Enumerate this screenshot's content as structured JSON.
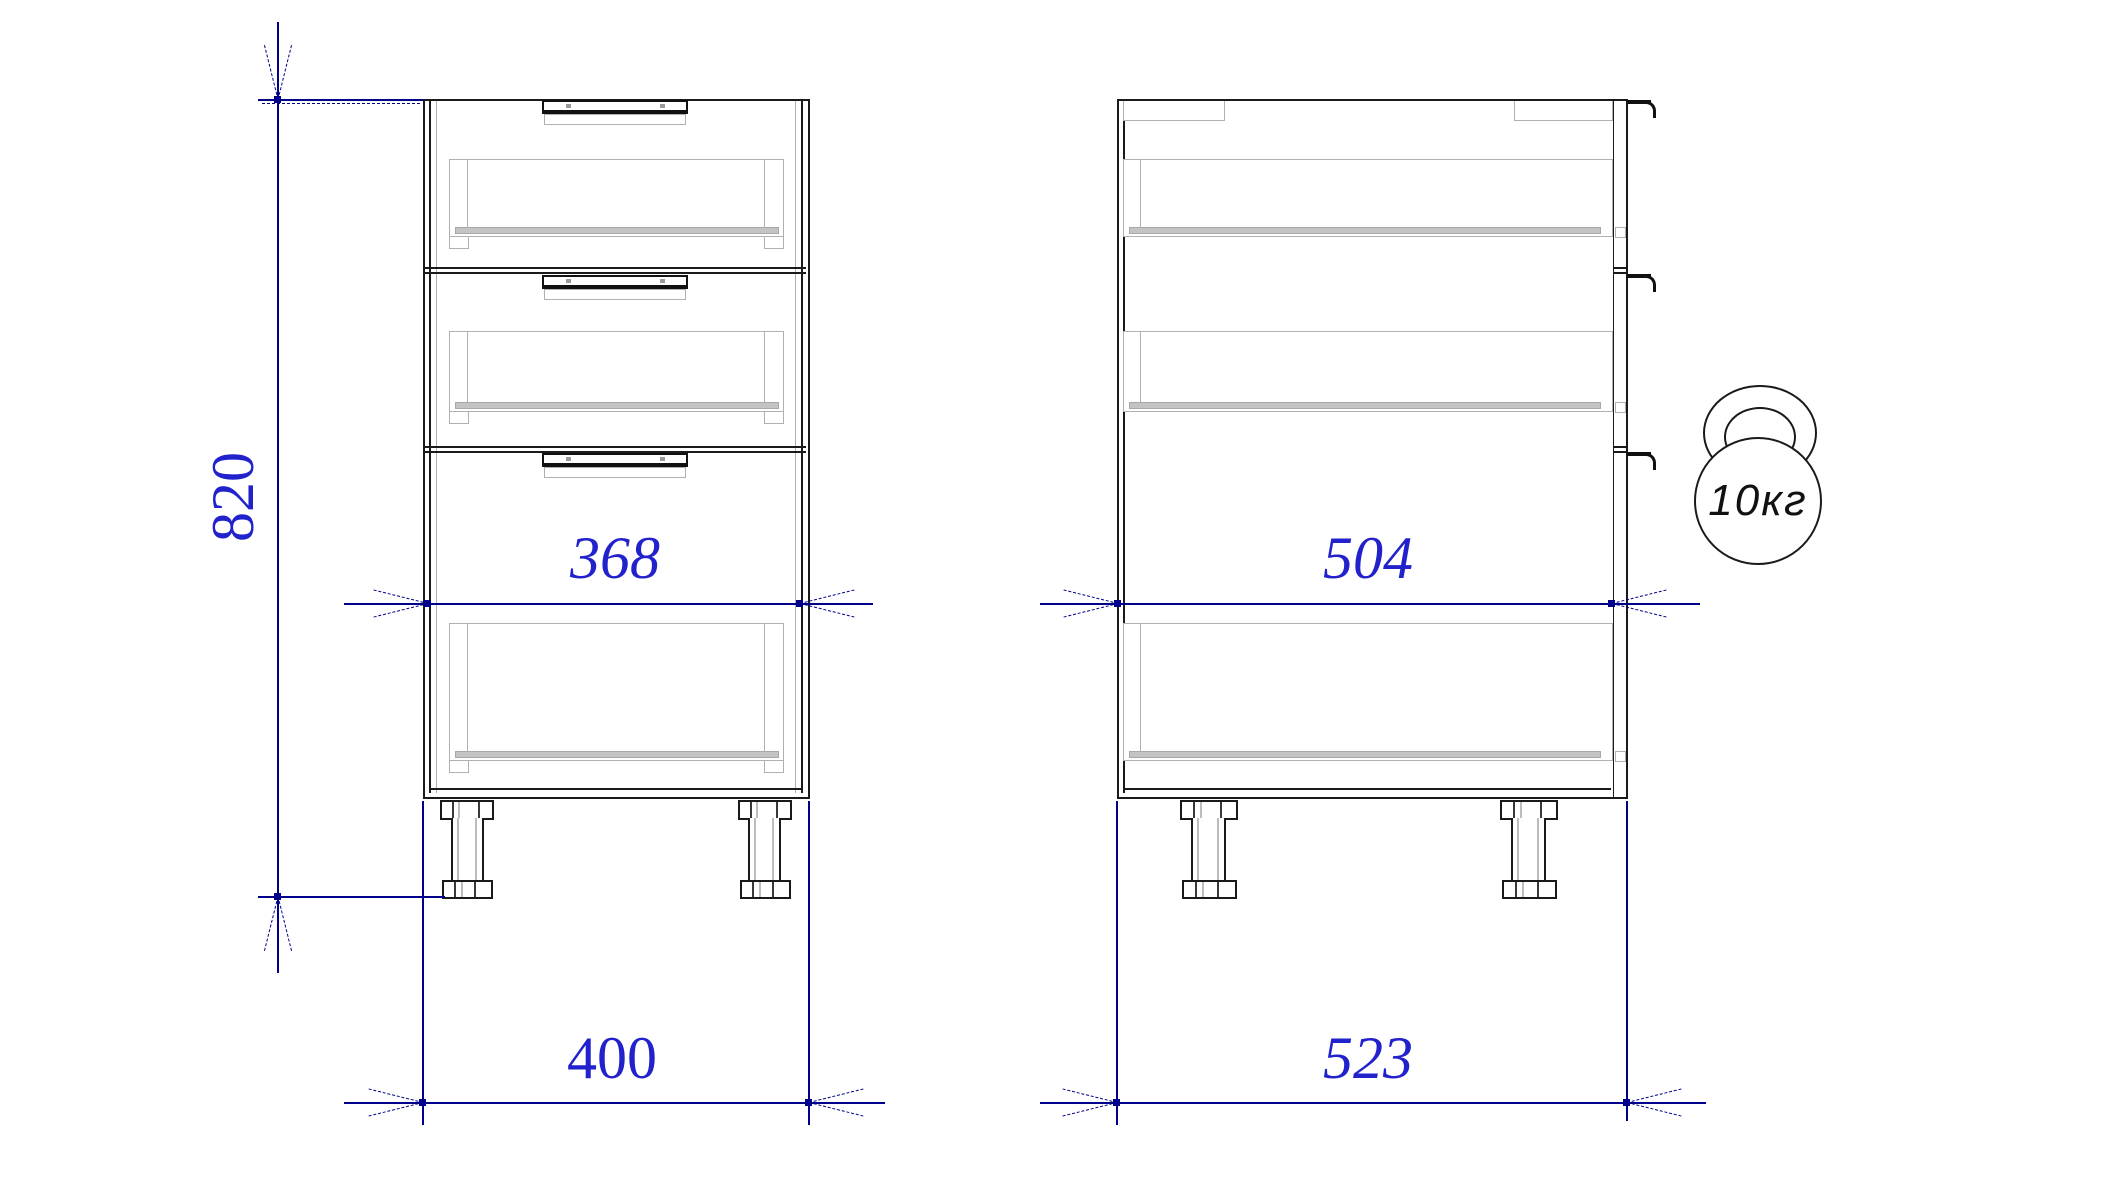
{
  "drawing": {
    "type": "cabinet technical drawing, front and side orthographic views",
    "views": {
      "front_view": {
        "drawer_count": 3
      },
      "side_view": {
        "drawer_count": 3
      }
    },
    "dimensions": {
      "height": {
        "label": "820",
        "orientation": "vertical",
        "applies_to": "overall height with legs"
      },
      "front_inner_width": {
        "label": "368",
        "orientation": "horizontal",
        "applies_to": "front interior width"
      },
      "front_outer_width": {
        "label": "400",
        "orientation": "horizontal",
        "applies_to": "front overall width"
      },
      "side_depth": {
        "label": "504",
        "orientation": "horizontal",
        "applies_to": "carcass depth"
      },
      "side_total_depth": {
        "label": "523",
        "orientation": "horizontal",
        "applies_to": "overall depth with drawer fronts"
      }
    },
    "badge": {
      "label": "10кг",
      "meaning": "max load kettlebell icon"
    },
    "colors": {
      "dimension_line": "#00008b",
      "dimension_text": "#2222cc",
      "outline": "#1a1a1a",
      "hidden_detail": "#b0b0b0",
      "background": "#ffffff"
    }
  }
}
